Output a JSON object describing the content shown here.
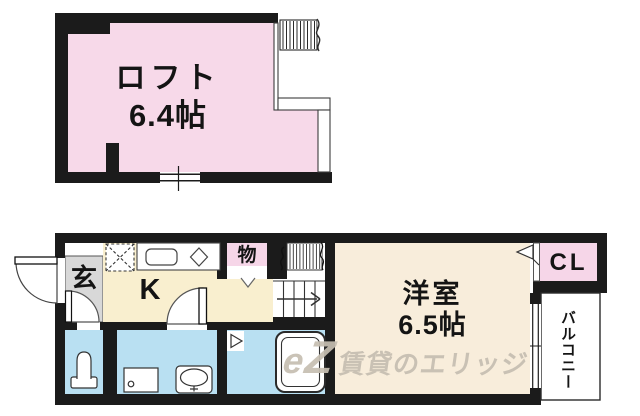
{
  "colors": {
    "wall": "#1b1b1b",
    "loft_pink": "#f7d9e9",
    "closet_pink": "#f6d6e8",
    "kitchen_cream": "#f9efcf",
    "room_cream": "#f8eddb",
    "wet_area_blue": "#b9e0f2",
    "entrance_gray": "#d8d8d8",
    "watermark_beige": "#c6beb1"
  },
  "loft_floor": {
    "room_label": "ロフト",
    "room_size": "6.4帖"
  },
  "main_floor": {
    "entrance_label": "玄",
    "kitchen_label": "K",
    "storage_label": "物",
    "room_label": "洋室",
    "room_size": "6.5帖",
    "closet_label": "CL",
    "balcony_label": "バルコニー"
  },
  "watermark": {
    "logo_script": "e",
    "logo_letter": "Z",
    "brand_text": "賃貸のエリッジ"
  }
}
